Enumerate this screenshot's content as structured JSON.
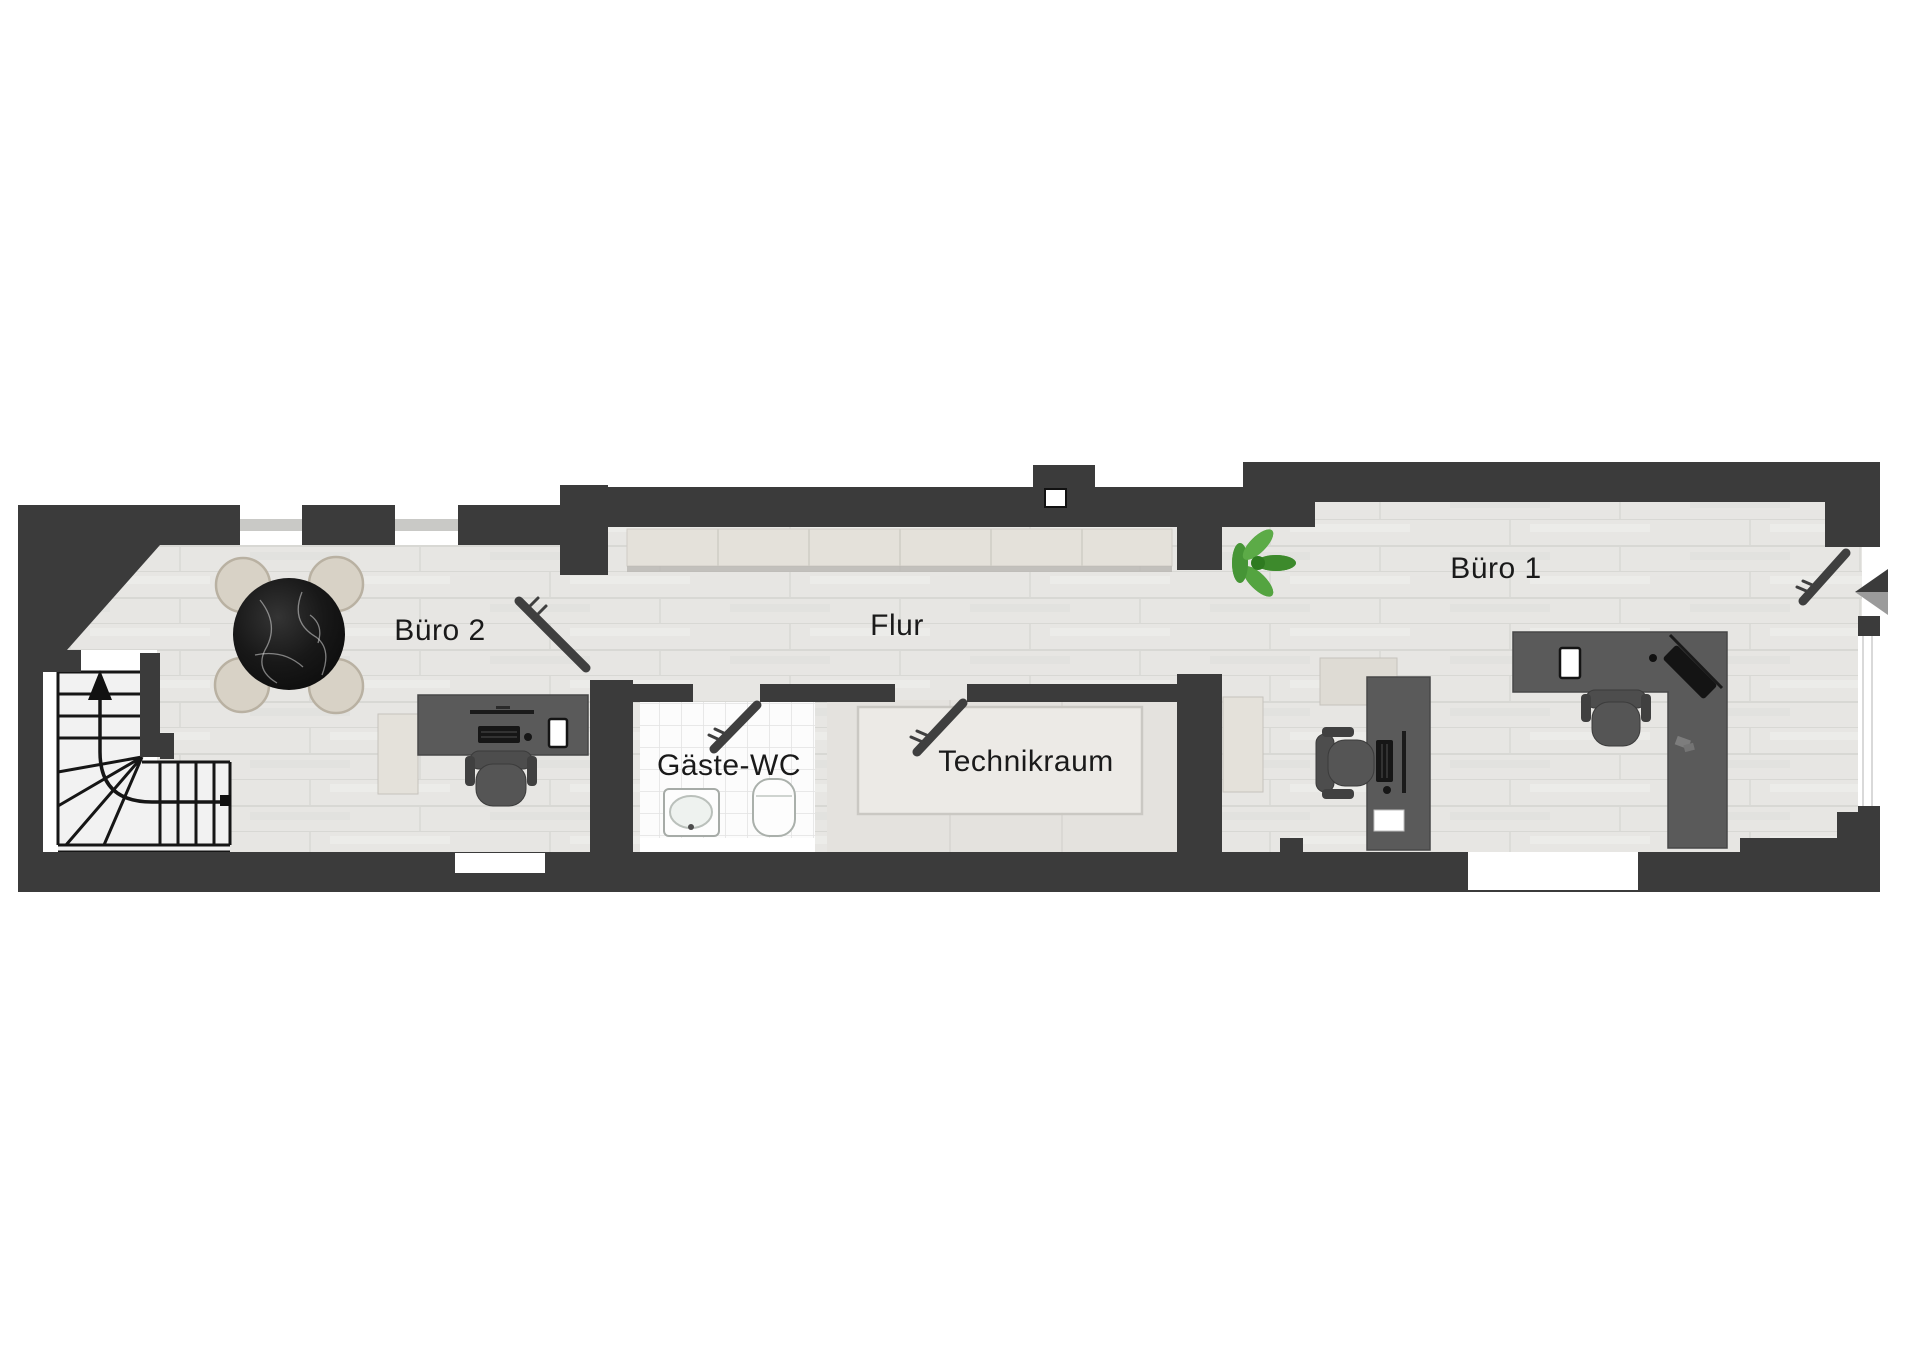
{
  "floor_plan": {
    "rooms": [
      {
        "id": "buero2",
        "label": "Büro 2"
      },
      {
        "id": "flur",
        "label": "Flur"
      },
      {
        "id": "gaeste_wc",
        "label": "Gäste-WC"
      },
      {
        "id": "technikraum",
        "label": "Technikraum"
      },
      {
        "id": "buero1",
        "label": "Büro 1"
      }
    ],
    "colors": {
      "wall": "#3b3b3b",
      "wood_floor": "#e7e6e3",
      "plank_line": "#d3d3d0",
      "tile_floor": "#fcfcfc",
      "tile_grout": "#e2e2e2",
      "technik_floor": "#e4e2de",
      "cabinet": "#e4e1da",
      "desk": "#5a5a5a",
      "office_chair": "#4d4d4d",
      "dining_chair": "#d8d2c6",
      "table_marble": "#1a1a1a",
      "plant": "#4a9a36",
      "door": "#3f3f3f",
      "window_sill": "#c9c9c6",
      "entrance_arrow_dark": "#3b3b3b",
      "entrance_arrow_light": "#9b9b9b"
    }
  }
}
